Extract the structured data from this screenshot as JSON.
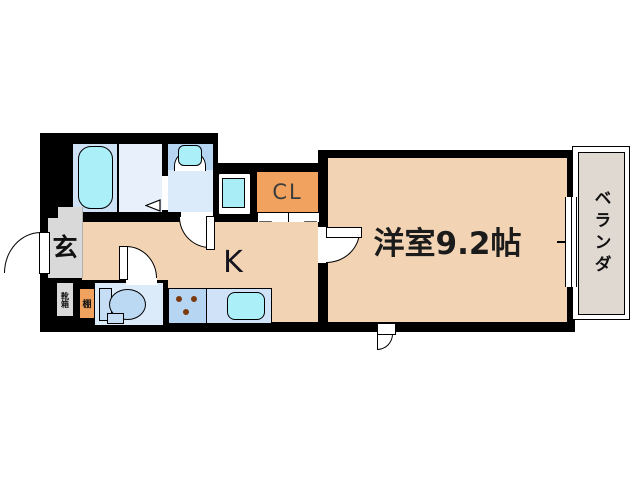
{
  "plan": {
    "type": "apartment-floor-plan",
    "labels": {
      "genkan": "玄",
      "shoe_box": "靴箱",
      "shelf": "棚",
      "kitchen": "K",
      "closet": "CL",
      "main_room": "洋室9.2帖",
      "veranda": "ベランダ"
    },
    "rooms": [
      {
        "id": "entrance",
        "label": "玄"
      },
      {
        "id": "kitchen",
        "label": "K"
      },
      {
        "id": "closet",
        "label": "CL"
      },
      {
        "id": "western-room",
        "label": "洋室9.2帖",
        "size_tatami": 9.2
      },
      {
        "id": "veranda",
        "label": "ベランダ"
      }
    ],
    "colors": {
      "wall": "#000000",
      "floor_tan": "#f2d3b3",
      "entrance_gray": "#d9d9d9",
      "bath_blue": "#cfe1f5",
      "changing_blue": "#e8f1fb",
      "wash_blue": "#dcebf9",
      "counter_blue": "#b5d5f2",
      "sink_unit_blue": "#cfe2f7",
      "water_cyan": "#abeff8",
      "closet_orange": "#f0a25e",
      "veranda_gray": "#e0d9d2"
    }
  }
}
